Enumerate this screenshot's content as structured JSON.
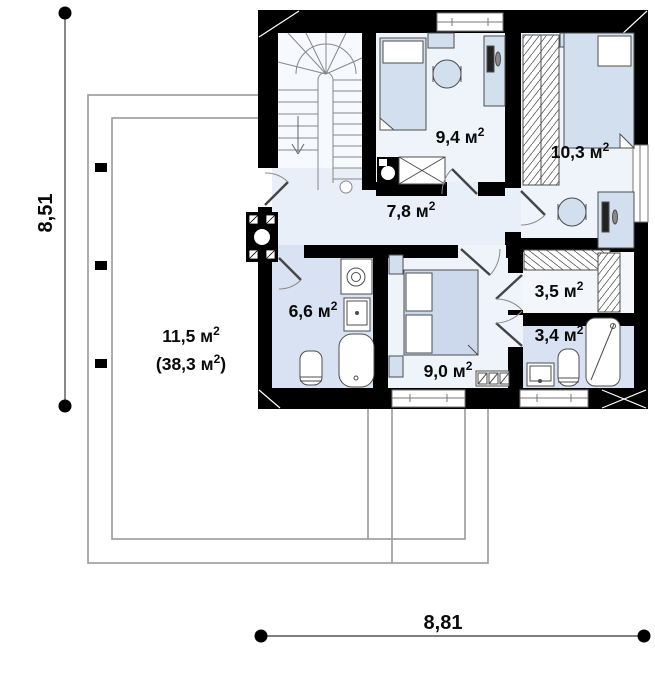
{
  "plan": {
    "type": "floor-plan",
    "units": "м²"
  },
  "dimensions": {
    "left": "8,51",
    "bottom": "8,81"
  },
  "rooms": [
    {
      "name": "hall",
      "area": "7,8 м",
      "sup": "2",
      "post": ""
    },
    {
      "name": "bedroom-1",
      "area": "9,4 м",
      "sup": "2",
      "post": ""
    },
    {
      "name": "bedroom-2",
      "area": "10,3 м",
      "sup": "2",
      "post": ""
    },
    {
      "name": "bathroom-1",
      "area": "6,6 м",
      "sup": "2",
      "post": ""
    },
    {
      "name": "bedroom-3",
      "area": "9,0 м",
      "sup": "2",
      "post": ""
    },
    {
      "name": "wardrobe",
      "area": "3,5 м",
      "sup": "2",
      "post": ""
    },
    {
      "name": "bathroom-2",
      "area": "3,4 м",
      "sup": "2",
      "post": ""
    }
  ],
  "terrace": {
    "line1_pre": "11,5 м",
    "line1_sup": "2",
    "line1_post": "",
    "line2_pre": "(38,3 м",
    "line2_sup": "2",
    "line2_post": ")"
  },
  "colors": {
    "wall": "#000000",
    "room_light": "#eff4fb",
    "room_lavender": "#d9e2f2",
    "hall": "#e8eff9",
    "stair": "#f6f9fd",
    "furniture": "#d2dfef",
    "roof_outline": "#9a9a9a"
  }
}
